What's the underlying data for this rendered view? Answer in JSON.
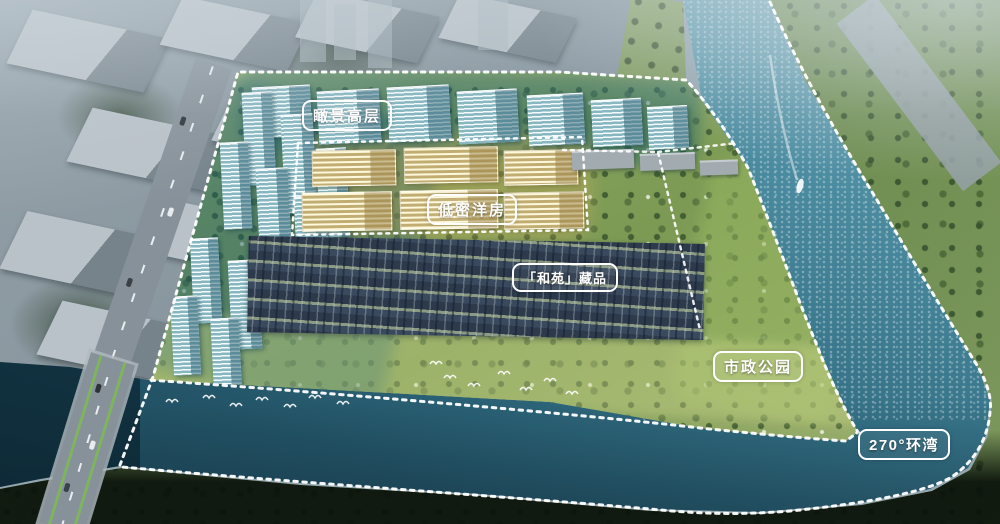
{
  "scene": {
    "type": "aerial-masterplan-render",
    "labels": {
      "highrise": "瞰景高层",
      "lowrise": "低密洋房",
      "collection": "「和苑」藏品",
      "park": "市政公园",
      "bay": "270°环湾"
    },
    "colors": {
      "highrise_highlight": "#bfe4ea",
      "lowrise_highlight": "#e7dba3",
      "townhouse": "#34445a",
      "park_green": "#8ba45f",
      "river": "#4b8ba0",
      "bay": "#1f4e62",
      "boundary_line": "#ffffff"
    }
  }
}
